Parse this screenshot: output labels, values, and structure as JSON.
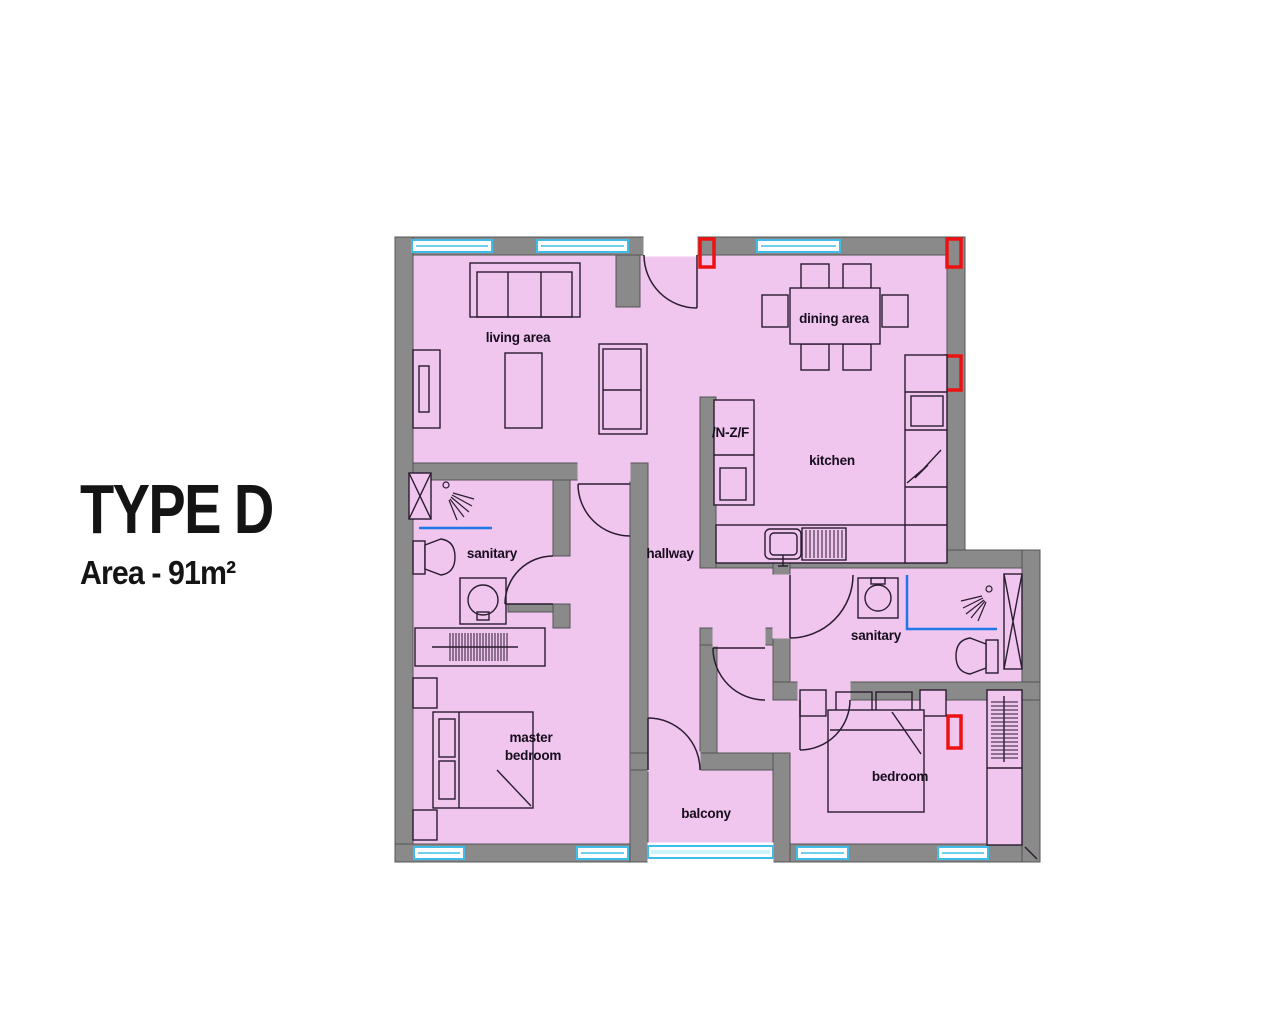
{
  "title": {
    "heading": "TYPE D",
    "subheading": "Area - 91m²"
  },
  "rooms": {
    "living_area": "living area",
    "dining_area": "dining area",
    "kitchen": "kitchen",
    "hallway": "hallway",
    "sanitary_left": "sanitary",
    "sanitary_right": "sanitary",
    "master_bedroom": {
      "line1": "master",
      "line2": "bedroom"
    },
    "balcony": "balcony",
    "bedroom": "bedroom",
    "shaft_label": "/N-Z/F"
  },
  "colors": {
    "floor": "#f0c5ee",
    "wall": "#8a8a8a",
    "edge": "#545454",
    "window": "#3fbde8",
    "windowlight": "#cdf2fb",
    "marker": "#ee1111",
    "line": "#2a1c30",
    "shower": "#2277e8",
    "text": "#160d1d"
  }
}
